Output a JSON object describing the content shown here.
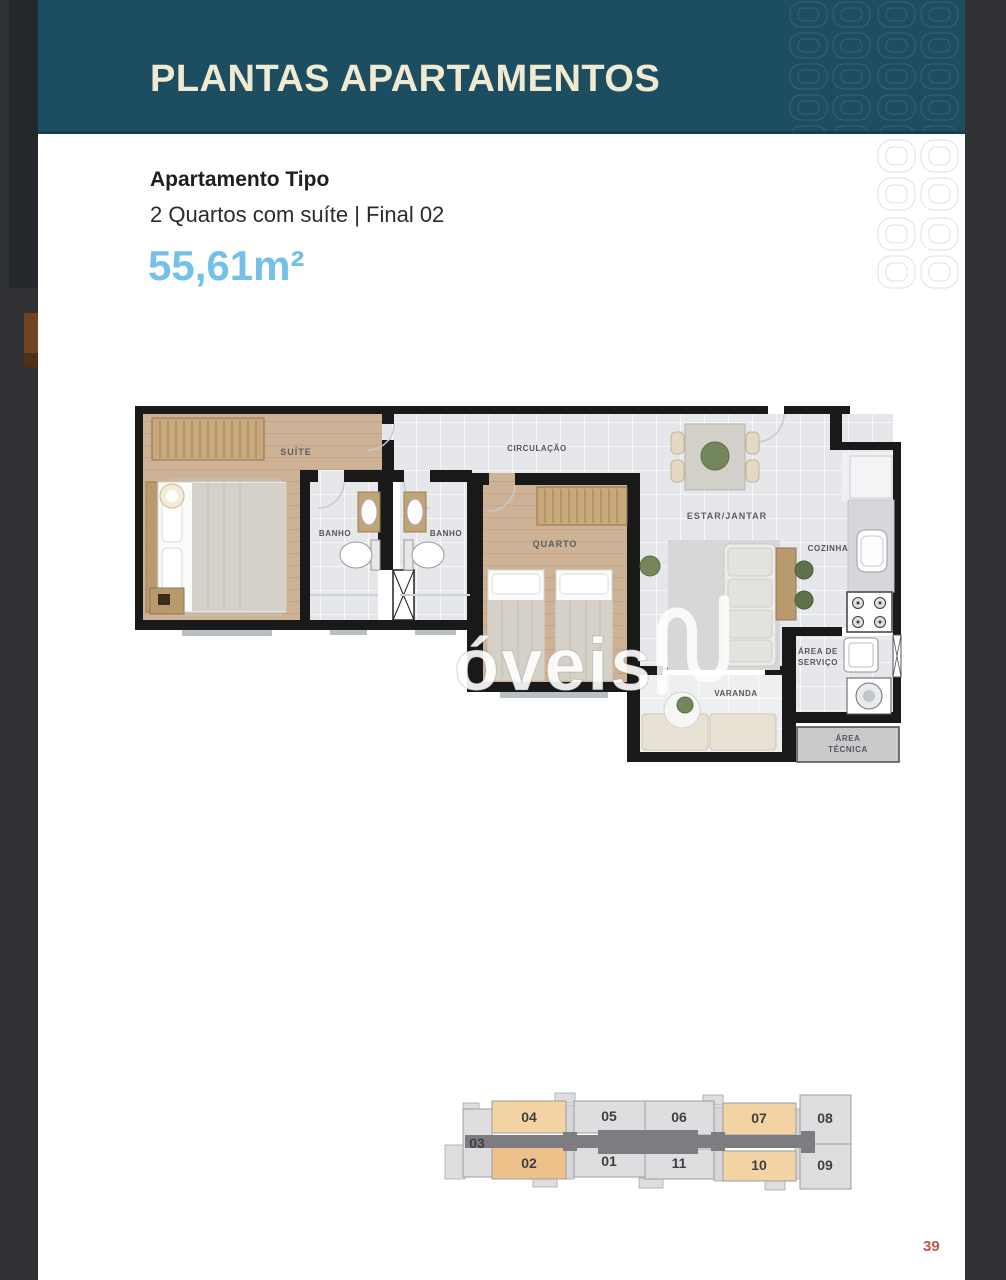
{
  "header": {
    "title": "PLANTAS APARTAMENTOS"
  },
  "apartment": {
    "title": "Apartamento Tipo",
    "subtitle": "2 Quartos com suíte | Final 02",
    "area": "55,61m²"
  },
  "floorplan": {
    "rooms": {
      "suite": "SUÍTE",
      "banho1": "BANHO",
      "banho2": "BANHO",
      "circulacao": "CIRCULAÇÃO",
      "quarto": "QUARTO",
      "estar": "ESTAR/JANTAR",
      "cozinha": "COZINHA",
      "servico_line1": "ÁREA DE",
      "servico_line2": "SERVIÇO",
      "varanda": "VARANDA",
      "tecnica_line1": "ÁREA",
      "tecnica_line2": "TÉCNICA"
    },
    "watermark_text": "óveis"
  },
  "keyplan": {
    "units": [
      {
        "label": "03",
        "color": "#dedee0",
        "highlighted": false
      },
      {
        "label": "04",
        "color": "#f3d2a4",
        "highlighted": false
      },
      {
        "label": "05",
        "color": "#dedee0",
        "highlighted": false
      },
      {
        "label": "06",
        "color": "#dedee0",
        "highlighted": false
      },
      {
        "label": "07",
        "color": "#f3d2a4",
        "highlighted": false
      },
      {
        "label": "08",
        "color": "#dedee0",
        "highlighted": false
      },
      {
        "label": "02",
        "color": "#eec18a",
        "highlighted": true
      },
      {
        "label": "01",
        "color": "#dedee0",
        "highlighted": false
      },
      {
        "label": "11",
        "color": "#dedee0",
        "highlighted": false
      },
      {
        "label": "10",
        "color": "#f3d2a4",
        "highlighted": false
      },
      {
        "label": "09",
        "color": "#dedee0",
        "highlighted": false
      }
    ],
    "corridor_color": "#7d7d81"
  },
  "page_number": "39",
  "colors": {
    "header_bg": "#1d4d61",
    "header_text": "#f0ead0",
    "area_text": "#74c0e8",
    "page_number": "#c2574f",
    "wall": "#191919",
    "wood_floor": "#cdb296",
    "tile_floor": "#e6e7ea",
    "keyplan_peach": "#f3d2a4",
    "keyplan_highlight": "#eec18a"
  }
}
